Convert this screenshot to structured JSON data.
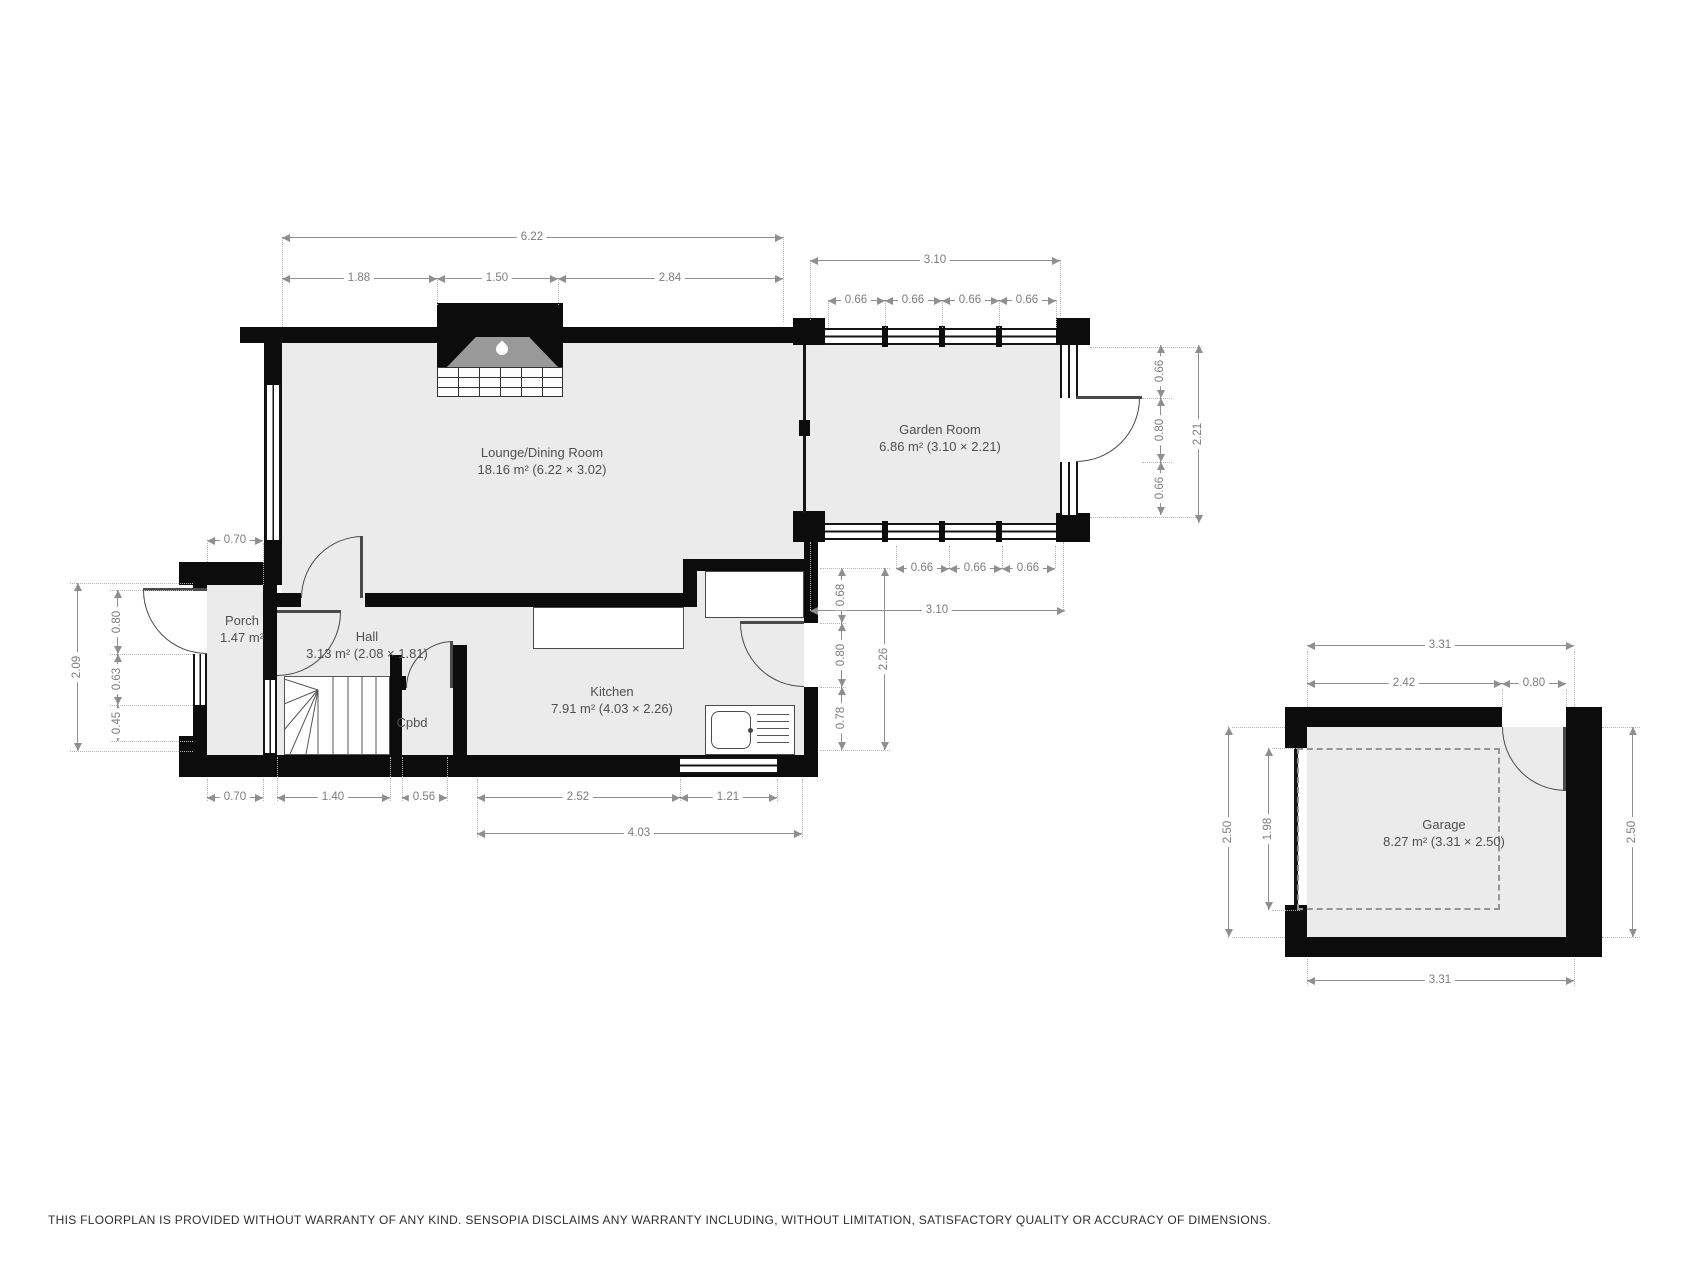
{
  "disclaimer": "THIS FLOORPLAN IS PROVIDED WITHOUT WARRANTY OF ANY KIND. SENSOPIA DISCLAIMS ANY WARRANTY INCLUDING, WITHOUT LIMITATION, SATISFACTORY QUALITY OR ACCURACY OF DIMENSIONS.",
  "colors": {
    "wall": "#0c0c0c",
    "room_fill": "#ebebeb",
    "dim_text": "#7d7d7d",
    "label_text": "#4f4f4f"
  },
  "icons": {
    "fireplace": "flame-icon"
  },
  "rooms": {
    "lounge": {
      "name": "Lounge/Dining Room",
      "area": "18.16 m² (6.22 × 3.02)"
    },
    "garden": {
      "name": "Garden Room",
      "area": "6.86 m² (3.10 × 2.21)"
    },
    "porch": {
      "name": "Porch",
      "area": "1.47 m²"
    },
    "hall": {
      "name": "Hall",
      "area": "3.13 m² (2.08 × 1.81)"
    },
    "cupboard": {
      "name": "Cpbd"
    },
    "kitchen": {
      "name": "Kitchen",
      "area": "7.91 m² (4.03 × 2.26)"
    },
    "garage": {
      "name": "Garage",
      "area": "8.27 m² (3.31 × 2.50)"
    }
  },
  "dims": {
    "lounge_width_total": "6.22",
    "lounge_seg_left": "1.88",
    "lounge_seg_fireplace": "1.50",
    "lounge_seg_right": "2.84",
    "garden_width_top": "3.10",
    "garden_win_top_1": "0.66",
    "garden_win_top_2": "0.66",
    "garden_win_top_3": "0.66",
    "garden_win_top_4": "0.66",
    "garden_right_win_top": "0.66",
    "garden_right_door": "0.80",
    "garden_right_win_bottom": "0.66",
    "garden_depth": "2.21",
    "garden_win_bottom_1": "0.66",
    "garden_win_bottom_2": "0.66",
    "garden_win_bottom_3": "0.66",
    "garden_width_bottom": "3.10",
    "kitchen_wall_top": "0.68",
    "kitchen_door": "0.80",
    "kitchen_wall_bottom": "0.78",
    "kitchen_depth": "2.26",
    "porch_width": "0.70",
    "left_depth": "2.09",
    "porch_door": "0.80",
    "porch_window": "0.63",
    "porch_wall": "0.45",
    "bottom_porch": "0.70",
    "bottom_stairs": "1.40",
    "bottom_cupboard": "0.56",
    "bottom_kitchen": "2.52",
    "bottom_kitchen_window": "1.21",
    "kitchen_width": "4.03",
    "garage_width_top": "3.31",
    "garage_top_left": "2.42",
    "garage_door": "0.80",
    "garage_depth_left": "2.50",
    "garage_inner_depth": "1.98",
    "garage_depth_right": "2.50",
    "garage_width_bottom": "3.31"
  }
}
